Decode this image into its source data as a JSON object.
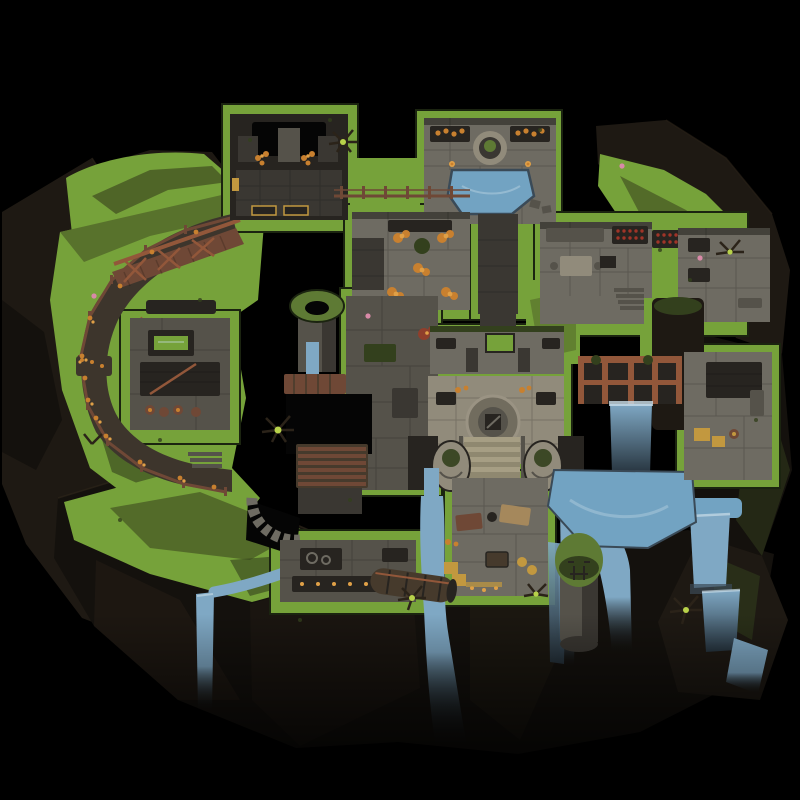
{
  "scene": {
    "title": "Isometric fantasy battlemap: cliffside keep with terraced rooms and waterfalls",
    "canvas": {
      "width": 800,
      "height": 800
    }
  },
  "features": [
    "shrine-room",
    "bath-pool-room",
    "flower-garden-room",
    "kitchen-hall",
    "wine-racks",
    "cliff-path",
    "wooden-bridge",
    "path-fence",
    "library-workshop",
    "map-table",
    "well-tower",
    "timber-platform",
    "plank-bridge",
    "dark-pit",
    "spiral-stair",
    "central-plaza",
    "round-emblem",
    "grand-stairs",
    "lion-statues",
    "study-room",
    "workshop-benches",
    "log-flume",
    "sluice-dam",
    "dam-waterfall",
    "plunge-pool",
    "storage-room",
    "rock-pillar",
    "sentinel-tower",
    "cliff-waterfalls",
    "grass-terraces"
  ],
  "palette": {
    "bg": "#000000",
    "rock_dark": "#14110d",
    "rock_mid": "#1e1913",
    "rock_light": "#2b2319",
    "grass": "#76a23a",
    "grass_dark": "#4b5e26",
    "moss": "#33401d",
    "grass_edge": "#1b2410",
    "stone_light": "#918b7b",
    "stone_mid": "#6e6b62",
    "stone_dark": "#55524a",
    "stone_deep": "#3a3732",
    "interior_dark": "#272420",
    "dirt": "#3d352c",
    "wood": "#6f4836",
    "wood_bright": "#92573a",
    "wood_dark": "#463a2c",
    "water": "#7fa8c4",
    "water_deep": "#3a4a57",
    "water_pool": "#72a3c2",
    "foam": "#c9dde8",
    "flower_orange": "#c8802f",
    "flower_orange_light": "#e0a047",
    "flower_red": "#8f3f2c",
    "crate_yellow": "#c2983f",
    "plant_bright": "#b8d24a",
    "tower_moss": "#5e7a34",
    "pink": "#d98aa8",
    "black_pit": "#050505",
    "beige_step": "#a69e84",
    "beige_step_dark": "#8f8870",
    "tan": "#a5885c",
    "wine_red": "#a03428",
    "emblem": "#716c5e"
  }
}
